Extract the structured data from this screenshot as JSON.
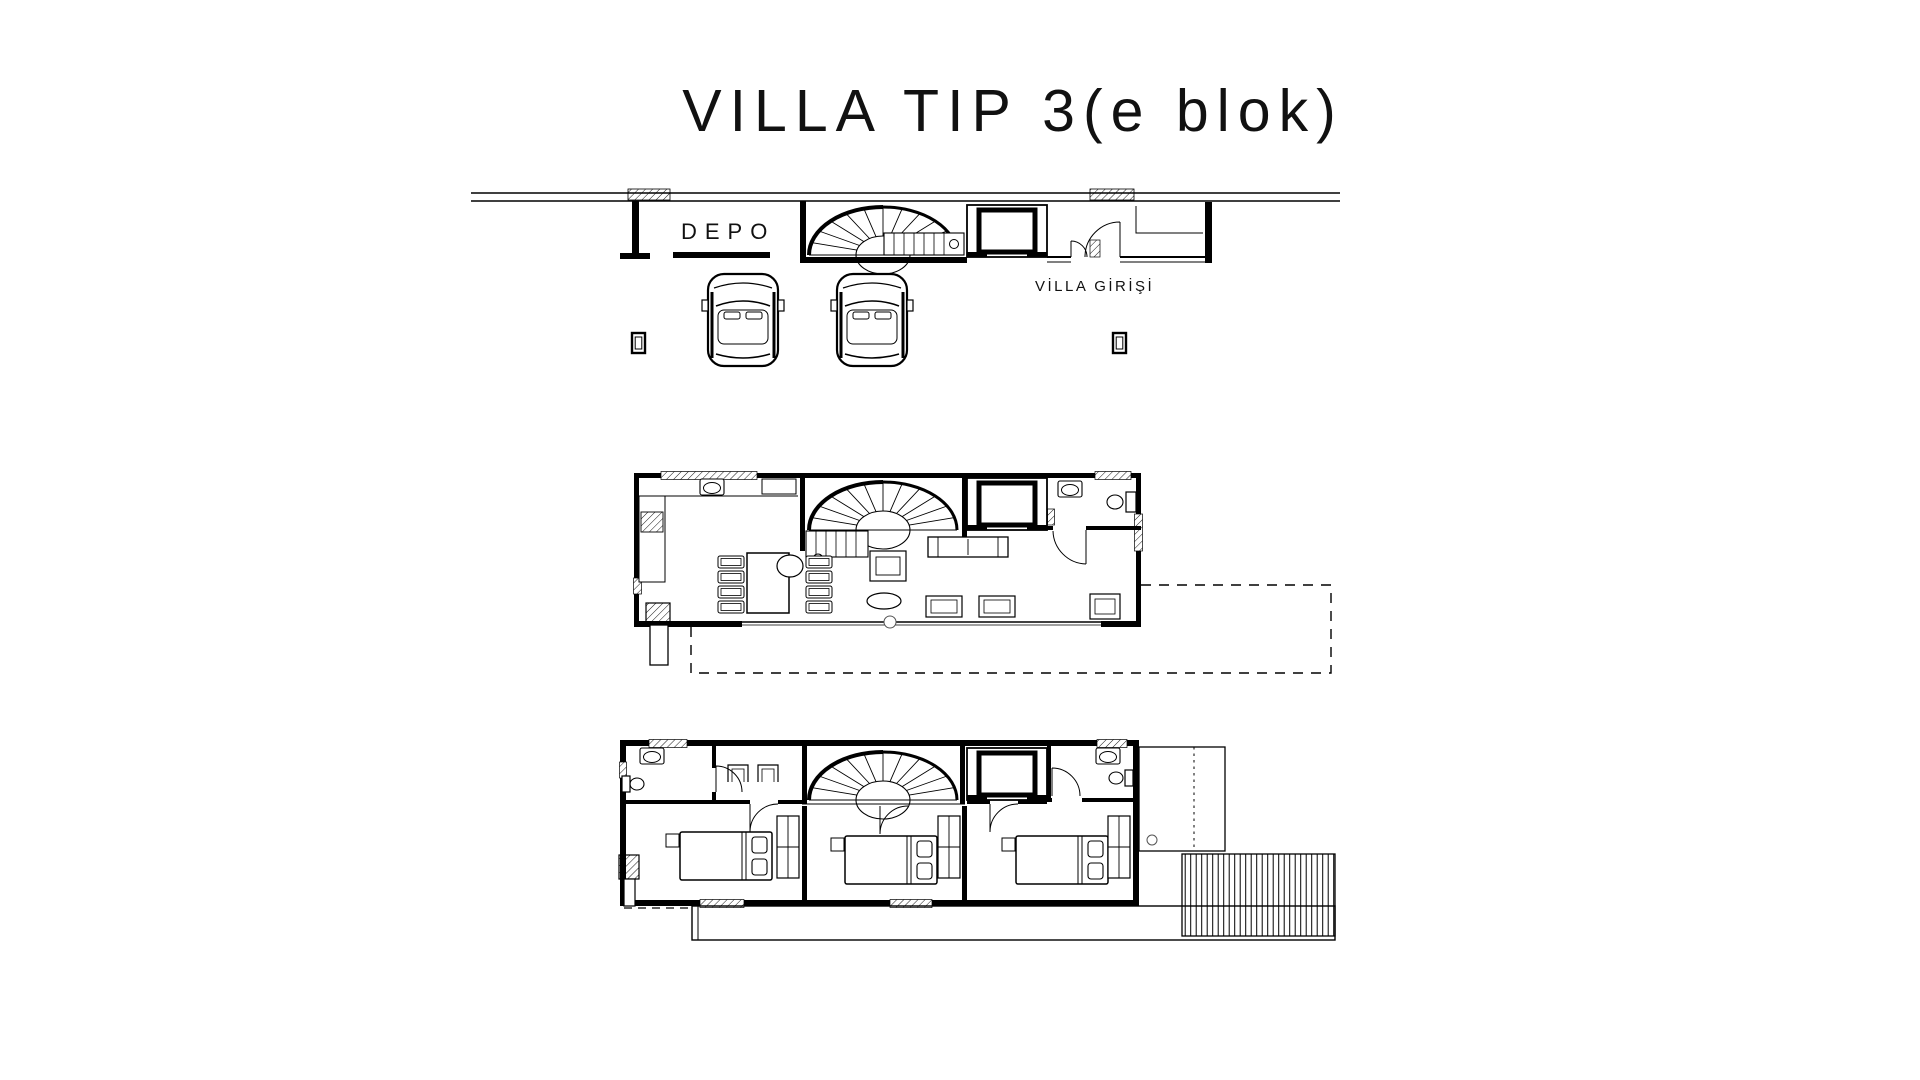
{
  "canvas": {
    "width": 1920,
    "height": 1080,
    "background": "#ffffff",
    "ink": "#000000"
  },
  "title": "VILLA TIP 3(e blok)",
  "floor_plans": {
    "garage_level": {
      "labels": {
        "storage_room": "DEPO",
        "villa_entrance": "VİLLA GİRİŞİ"
      }
    },
    "ground_level": {
      "labels": {}
    },
    "bedroom_level": {
      "labels": {}
    }
  }
}
